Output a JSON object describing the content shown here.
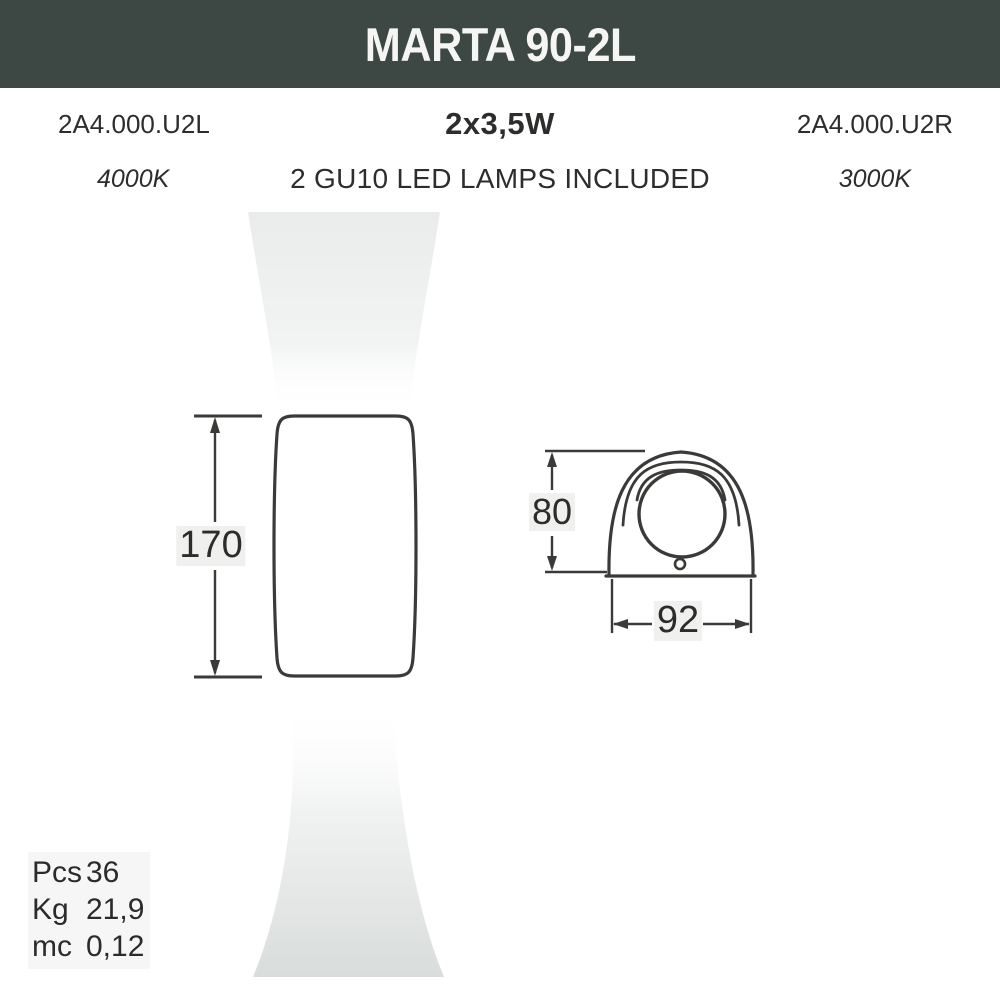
{
  "header": {
    "title": "MARTA 90-2L"
  },
  "specs": {
    "code_left": "2A4.000.U2L",
    "wattage": "2x3,5W",
    "code_right": "2A4.000.U2R",
    "temp_left": "4000K",
    "lamps_included": "2 GU10 LED LAMPS INCLUDED",
    "temp_right": "3000K"
  },
  "dimensions": {
    "front_height": "170",
    "side_height": "80",
    "side_width": "92"
  },
  "packaging": {
    "rows": [
      {
        "label": "Pcs",
        "value": "36"
      },
      {
        "label": "Kg",
        "value": "21,9"
      },
      {
        "label": "mc",
        "value": "0,12"
      }
    ]
  },
  "colors": {
    "header_bg": "#3d4744",
    "header_text": "#f5f6f4",
    "drawing_line": "#3b3a38",
    "beam_top": "#e9eceb",
    "beam_bottom": "#d8dcda"
  }
}
